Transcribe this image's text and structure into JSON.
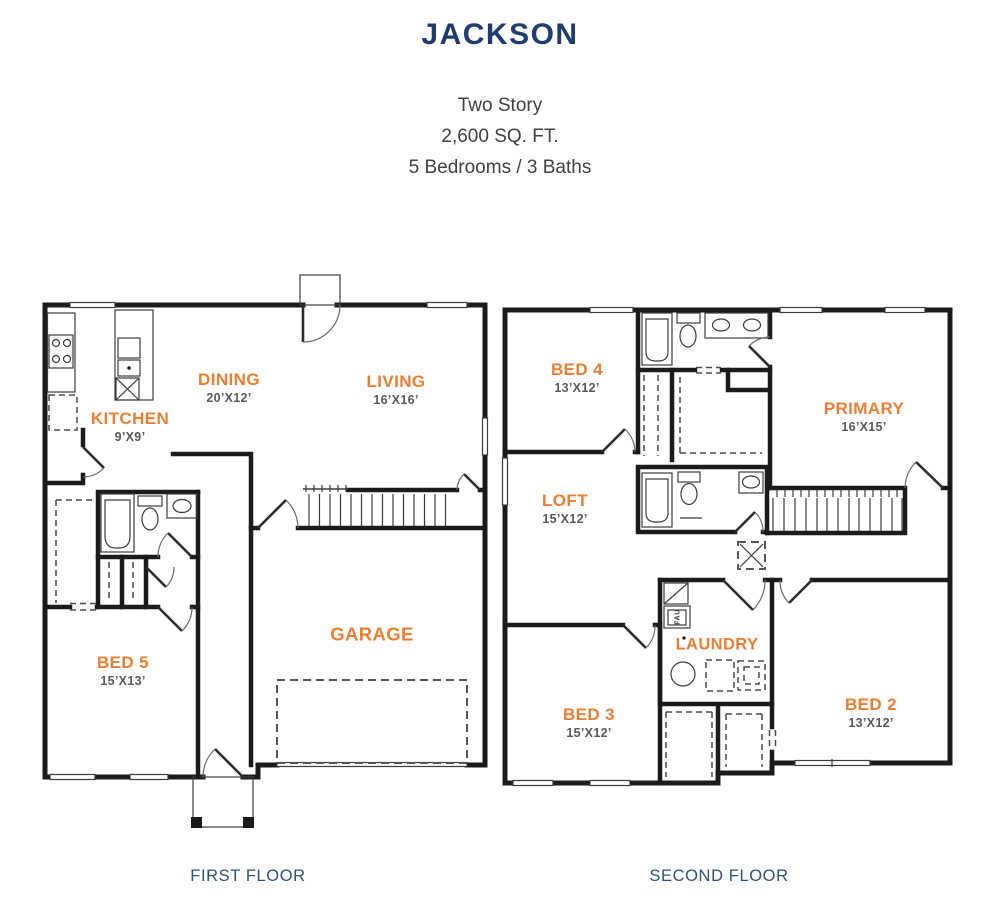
{
  "page": {
    "title": "JACKSON",
    "subtitle_lines": [
      "Two Story",
      "2,600 SQ. FT.",
      "5 Bedrooms / 3 Baths"
    ]
  },
  "colors": {
    "accent_orange": "#ee7e31",
    "title_navy": "#1e3d6e",
    "caption_blue": "#2f517e",
    "dims_gray": "#59595b",
    "wall_black": "#1b1b1b"
  },
  "floors": [
    {
      "caption": "FIRST FLOOR",
      "rooms": [
        {
          "name": "DINING",
          "dims": "20’X12’"
        },
        {
          "name": "LIVING",
          "dims": "16’X16’"
        },
        {
          "name": "KITCHEN",
          "dims": "9’X9’"
        },
        {
          "name": "GARAGE",
          "dims": ""
        },
        {
          "name": "BED 5",
          "dims": "15’X13’"
        }
      ]
    },
    {
      "caption": "SECOND FLOOR",
      "rooms": [
        {
          "name": "BED 4",
          "dims": "13’X12’"
        },
        {
          "name": "PRIMARY",
          "dims": "16’X15’"
        },
        {
          "name": "LOFT",
          "dims": "15’X12’"
        },
        {
          "name": "LAUNDRY",
          "dims": ""
        },
        {
          "name": "BED 3",
          "dims": "15’X12’"
        },
        {
          "name": "BED 2",
          "dims": "13’X12’"
        }
      ]
    }
  ],
  "annotations": {
    "fau_label": "FAU"
  }
}
